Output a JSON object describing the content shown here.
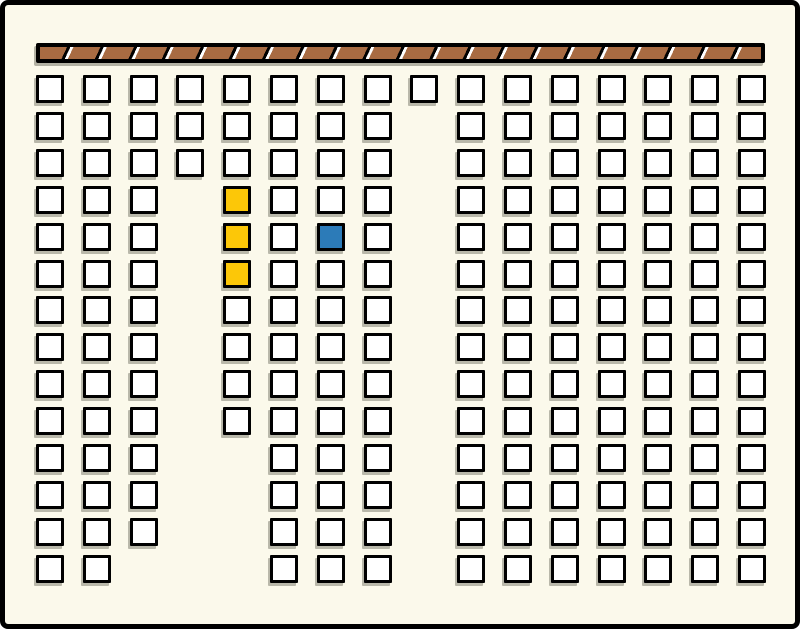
{
  "board": {
    "background_color": "#FBF9EB",
    "wall": {
      "description": "hatched-wall-bar",
      "segment_count": 22,
      "fill_color": "#A86B42",
      "stripe_color": "#FFFFFF",
      "border_color": "#000000"
    },
    "grid": {
      "num_columns": 16,
      "num_rows": 14,
      "cell_fill": "#FFFFFF",
      "cell_border": "#000000",
      "cell_shadow": "#9A9A8E",
      "columns": [
        {
          "col": 1,
          "row_start": 1,
          "row_end": 14
        },
        {
          "col": 2,
          "row_start": 1,
          "row_end": 14
        },
        {
          "col": 3,
          "row_start": 1,
          "row_end": 13
        },
        {
          "col": 4,
          "row_start": 1,
          "row_end": 3
        },
        {
          "col": 5,
          "row_start": 1,
          "row_end": 10
        },
        {
          "col": 6,
          "row_start": 1,
          "row_end": 14
        },
        {
          "col": 7,
          "row_start": 1,
          "row_end": 14
        },
        {
          "col": 8,
          "row_start": 1,
          "row_end": 14
        },
        {
          "col": 9,
          "row_start": 1,
          "row_end": 1
        },
        {
          "col": 10,
          "row_start": 1,
          "row_end": 14
        },
        {
          "col": 11,
          "row_start": 1,
          "row_end": 14
        },
        {
          "col": 12,
          "row_start": 1,
          "row_end": 14
        },
        {
          "col": 13,
          "row_start": 1,
          "row_end": 14
        },
        {
          "col": 14,
          "row_start": 1,
          "row_end": 14
        },
        {
          "col": 15,
          "row_start": 1,
          "row_end": 14
        },
        {
          "col": 16,
          "row_start": 1,
          "row_end": 14
        }
      ]
    },
    "highlights": [
      {
        "col": 5,
        "row": 4,
        "color_key": "yellow"
      },
      {
        "col": 5,
        "row": 5,
        "color_key": "yellow"
      },
      {
        "col": 5,
        "row": 6,
        "color_key": "yellow"
      },
      {
        "col": 7,
        "row": 5,
        "color_key": "blue"
      }
    ],
    "colors": {
      "yellow": "#FCC708",
      "blue": "#2C7BB8"
    }
  }
}
